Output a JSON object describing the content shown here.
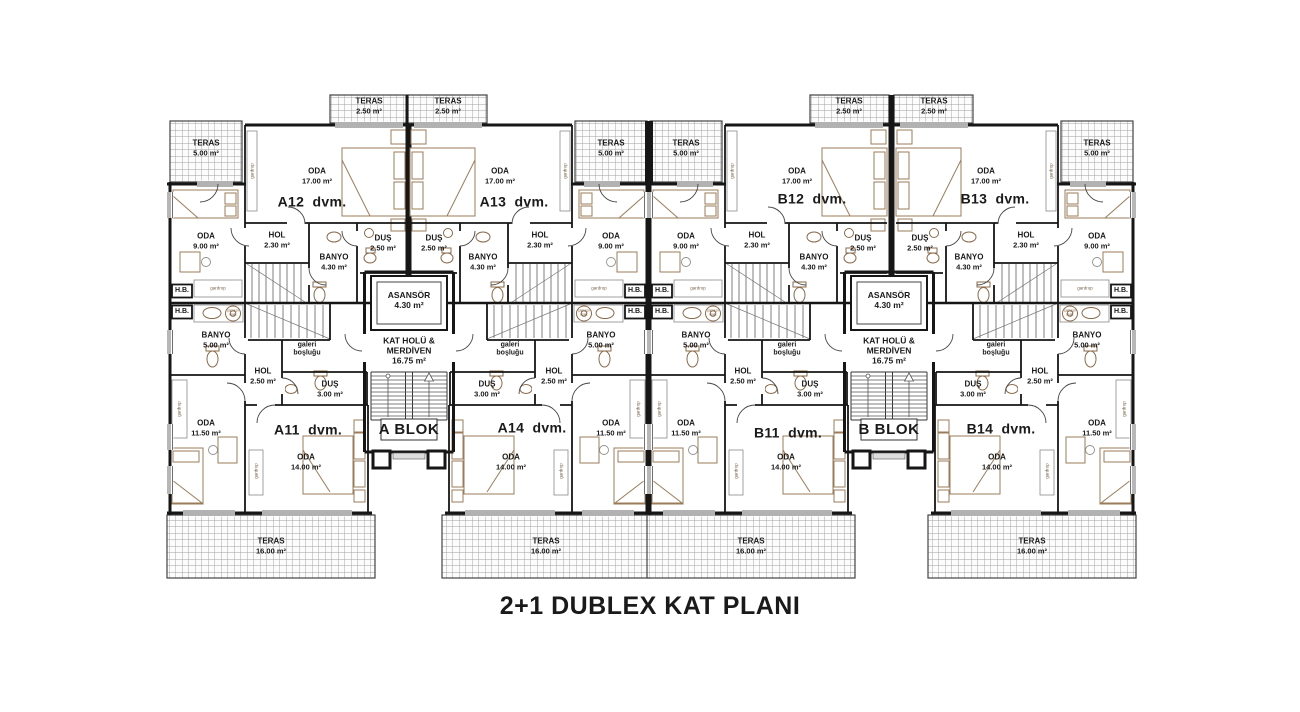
{
  "title": "2+1 DUBLEX KAT PLANI",
  "blocks": {
    "a": "A BLOK",
    "b": "B BLOK"
  },
  "units": {
    "a11": "A11  dvm.",
    "a12": "A12  dvm.",
    "a13": "A13  dvm.",
    "a14": "A14  dvm.",
    "b11": "B11  dvm.",
    "b12": "B12  dvm.",
    "b13": "B13  dvm.",
    "b14": "B14  dvm."
  },
  "rooms": {
    "teras250": {
      "name": "TERAS",
      "area": "2.50 m²"
    },
    "teras500": {
      "name": "TERAS",
      "area": "5.00 m²"
    },
    "teras1600": {
      "name": "TERAS",
      "area": "16.00 m²"
    },
    "oda17": {
      "name": "ODA",
      "area": "17.00 m²"
    },
    "oda9": {
      "name": "ODA",
      "area": "9.00 m²"
    },
    "oda115": {
      "name": "ODA",
      "area": "11.50 m²"
    },
    "oda14": {
      "name": "ODA",
      "area": "14.00 m²"
    },
    "hol230": {
      "name": "HOL",
      "area": "2.30 m²"
    },
    "hol250": {
      "name": "HOL",
      "area": "2.50 m²"
    },
    "banyo430": {
      "name": "BANYO",
      "area": "4.30 m²"
    },
    "banyo500": {
      "name": "BANYO",
      "area": "5.00 m²"
    },
    "dus250": {
      "name": "DUŞ",
      "area": "2.50 m²"
    },
    "dus300": {
      "name": "DUŞ",
      "area": "3.00 m²"
    },
    "asansor": {
      "name": "ASANSÖR",
      "area": "4.30 m²"
    },
    "kathol": {
      "name": "KAT HOLÜ &",
      "name2": "MERDİVEN",
      "area": "16.75 m²"
    },
    "galeri": {
      "name": "galeri",
      "name2": "boşluğu"
    },
    "hb": "H.B.",
    "gardrop": "gardrop",
    "camasir": {
      "name": "çamaşır",
      "name2": "mak."
    }
  },
  "colors": {
    "wall": "#161616",
    "furniture": "#9a7b5a",
    "fixture": "#8a6a4a",
    "hatch": "#9f9f9f",
    "text": "#1a1a1a"
  }
}
